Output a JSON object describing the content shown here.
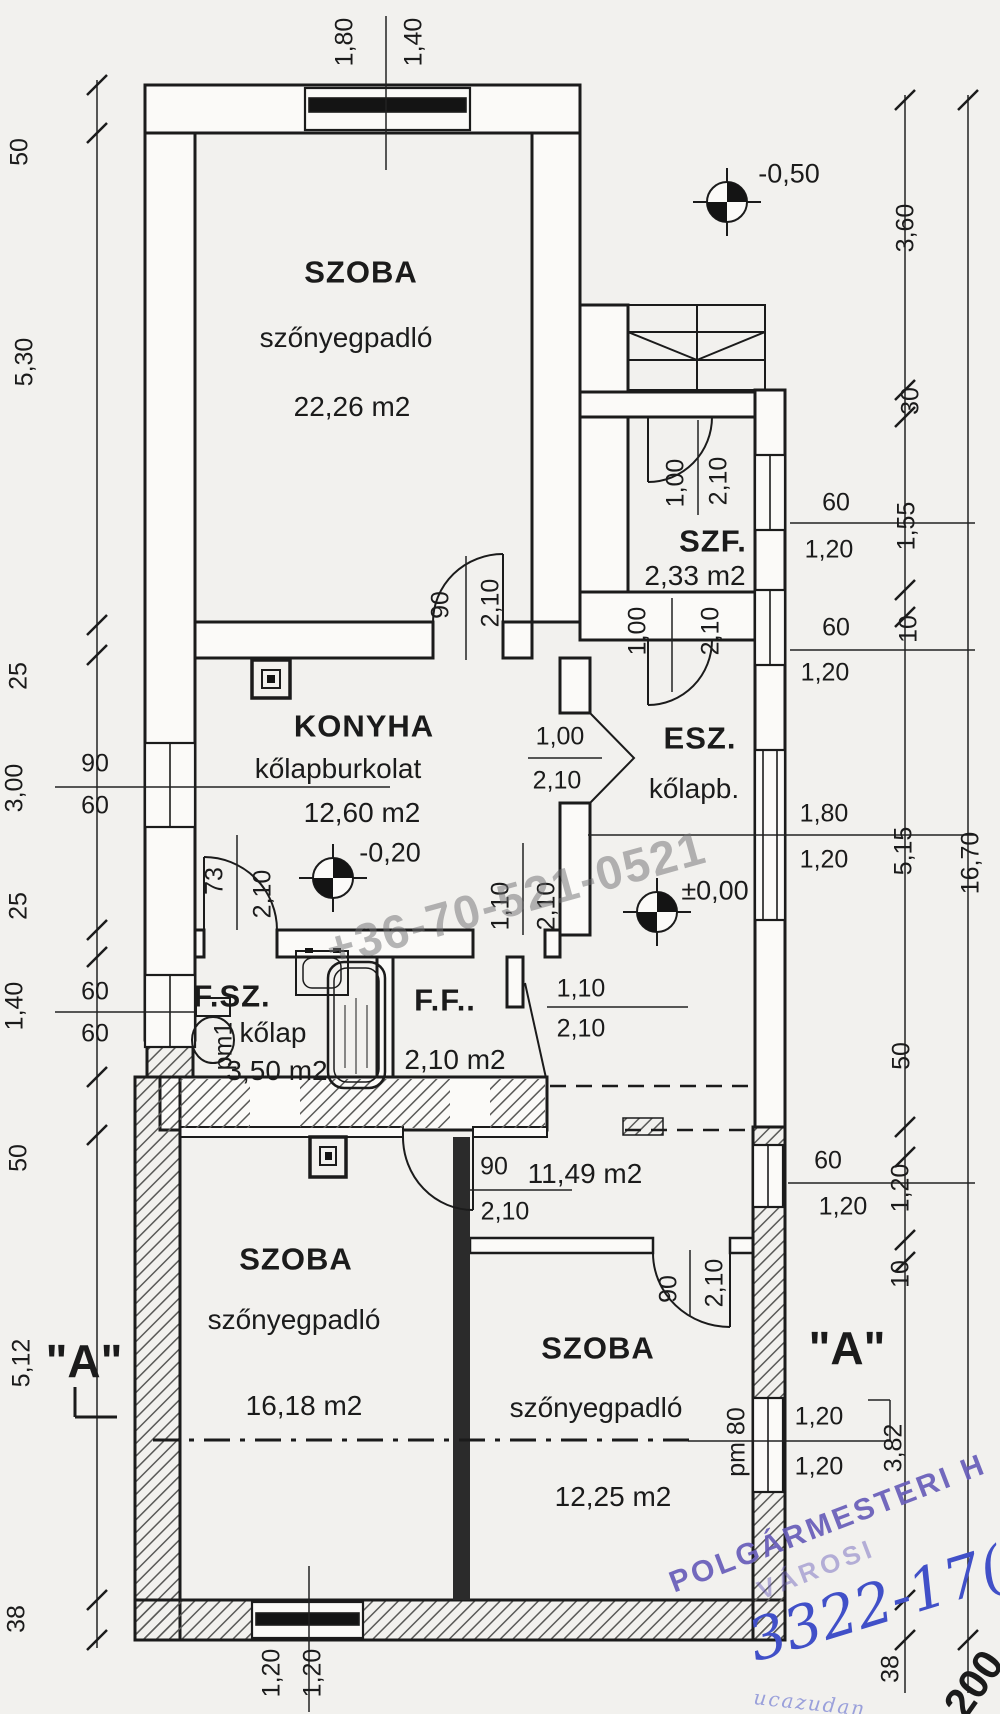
{
  "watermark": "+36-70-521-0521",
  "rooms": {
    "szoba1": {
      "name": "SZOBA",
      "floor": "szőnyegpadló",
      "area": "22,26 m2"
    },
    "szf": {
      "name": "SZF.",
      "area": "2,33 m2"
    },
    "konyha": {
      "name": "KONYHA",
      "floor": "kőlapburkolat",
      "area": "12,60 m2"
    },
    "esz": {
      "name": "ESZ.",
      "floor": "kőlapb."
    },
    "fsz": {
      "name": "F.SZ.",
      "floor": "kőlap",
      "area": "3,50 m2"
    },
    "ff": {
      "name": "F.F..",
      "area": "2,10 m2"
    },
    "hall": {
      "area": "11,49 m2"
    },
    "szoba2": {
      "name": "SZOBA",
      "floor": "szőnyegpadló",
      "area": "16,18 m2"
    },
    "szoba3": {
      "name": "SZOBA",
      "floor": "szőnyegpadló",
      "area": "12,25 m2"
    }
  },
  "levels": {
    "entry": "-0,50",
    "konyha": "-0,20",
    "esz": "±0,00"
  },
  "section": {
    "label": "\"A\""
  },
  "dims": {
    "top_window": [
      "1,80",
      "1,40"
    ],
    "left_chain": [
      "50",
      "5,30",
      "25",
      "3,00",
      "25",
      "1,40",
      "50",
      "5,12",
      "38"
    ],
    "left_win1": [
      "90",
      "60"
    ],
    "left_win2": [
      "60",
      "60"
    ],
    "right_chain": [
      "3,60",
      "30",
      "1,55",
      "10",
      "5,15",
      "50",
      "1,20",
      "10",
      "3,82",
      "38"
    ],
    "right_total": "16,70",
    "win_r1": [
      "60",
      "1,20"
    ],
    "win_r2": [
      "60",
      "1,20"
    ],
    "win_r3": [
      "1,80",
      "1,20"
    ],
    "win_r4": [
      "60",
      "1,20"
    ],
    "win_r5": [
      "1,20",
      "1,20"
    ],
    "win_r5_pm": "pm 80",
    "win_bottom": [
      "1,20",
      "1,20"
    ],
    "wc_pm": "pm1"
  },
  "doors": {
    "d1": [
      "90",
      "2,10"
    ],
    "d2": [
      "1,00",
      "2,10"
    ],
    "d3": [
      "1,00",
      "2,10"
    ],
    "d4": [
      "1,00",
      "2,10"
    ],
    "d5": [
      "73",
      "2,10"
    ],
    "d6": [
      "1,10",
      "2,10"
    ],
    "d7": [
      "1,10",
      "2,10"
    ],
    "d8": [
      "90",
      "2,10"
    ],
    "d9": [
      "90",
      "2,10"
    ]
  },
  "stamp": {
    "office": "POLGÁRMESTERI H",
    "city": "VÁROSI",
    "number": "3322-17(",
    "year": "200",
    "arc": "ucazudan"
  }
}
